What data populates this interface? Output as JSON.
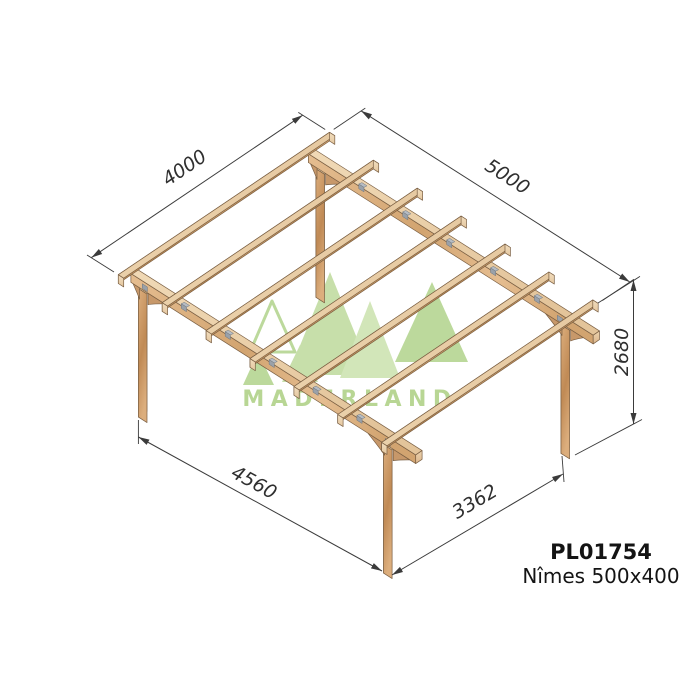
{
  "product": {
    "code": "PL01754",
    "name": "Nîmes 500x400",
    "text_color": "#141414"
  },
  "watermark": {
    "brand": "MADERLAND",
    "fill": "#c3dda3",
    "fill2": "#b7d694",
    "fill3": "#cfe4b4",
    "stroke": "#b7d694",
    "text": "#b2d38c"
  },
  "dimensions": [
    {
      "id": "roof-depth",
      "label": "4000"
    },
    {
      "id": "roof-width",
      "label": "5000"
    },
    {
      "id": "height",
      "label": "2680"
    },
    {
      "id": "front-spacing",
      "label": "4560"
    },
    {
      "id": "side-spacing",
      "label": "3362"
    }
  ],
  "colors": {
    "wood": {
      "top": [
        "#f0d9b6",
        "#e3c49a"
      ],
      "side": [
        "#d6a671",
        "#bd8a53"
      ],
      "face": [
        "#e5bd90",
        "#d2a470"
      ],
      "cap": [
        "#ecd3ae",
        "#dcb68c"
      ],
      "cap_bright": [
        "#f2debf",
        "#e4c69e"
      ],
      "post_left": [
        "#c39160",
        "#aa7643"
      ],
      "post_front": [
        "#dcae7d",
        "#c08a55"
      ],
      "brace": "#c7986a",
      "outline": "#7a5f43"
    },
    "metal": {
      "plate": "#9aa1a9",
      "flange": "#b6bcc3",
      "stroke": "#6e757d"
    },
    "annotation": {
      "line": "#3b3b3b",
      "text": "#2f2f2f"
    }
  }
}
